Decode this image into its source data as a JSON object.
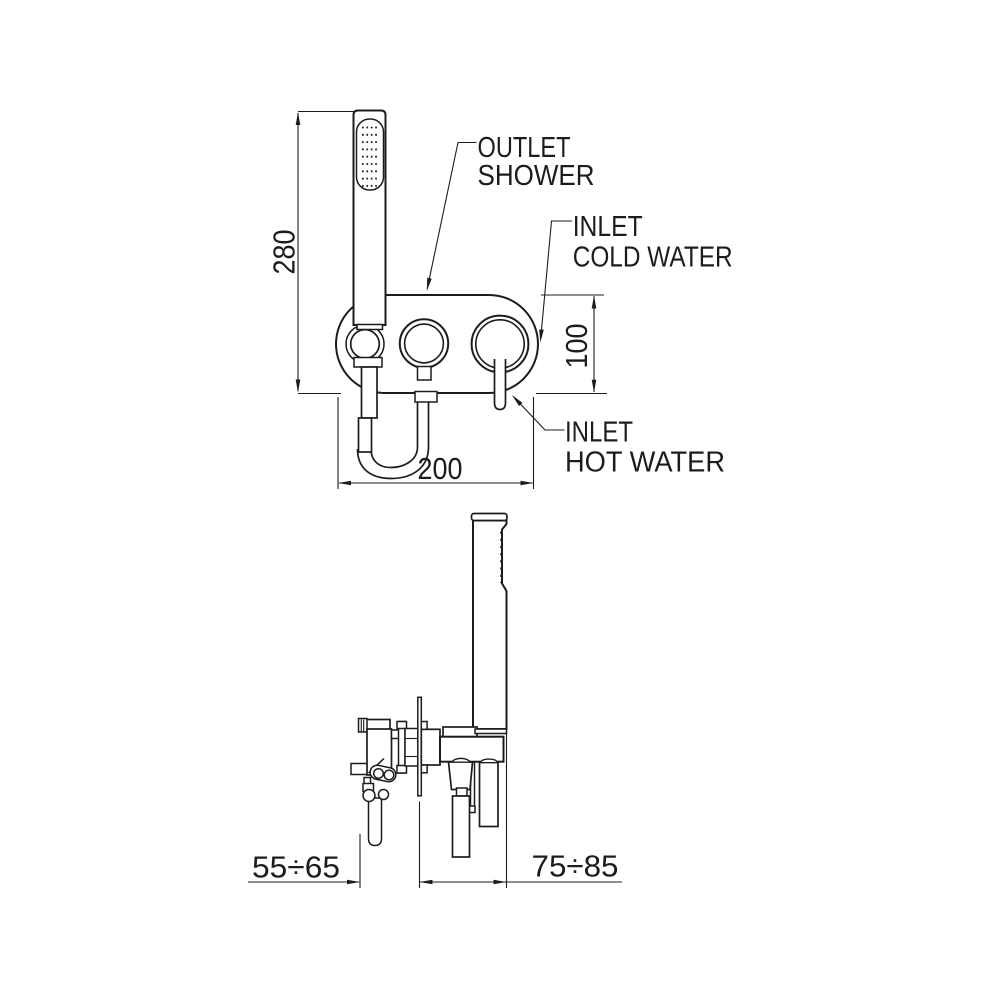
{
  "drawing": {
    "title_semantics": "shower mixer installation drawing",
    "colors": {
      "background": "#ffffff",
      "line": "#1c1c1c"
    },
    "front_view": {
      "labels": {
        "outlet_shower": {
          "line1": "OUTLET",
          "line2": "SHOWER"
        },
        "inlet_cold_water": {
          "line1": "INLET",
          "line2": "COLD WATER"
        },
        "inlet_hot_water": {
          "line1": "INLET",
          "line2": "HOT WATER"
        }
      },
      "dimensions": {
        "overall_height": "280",
        "body_height": "100",
        "body_width": "200"
      }
    },
    "side_view": {
      "dimensions": {
        "recess_depth": "55÷65",
        "protrusion_depth": "75÷85"
      }
    }
  }
}
